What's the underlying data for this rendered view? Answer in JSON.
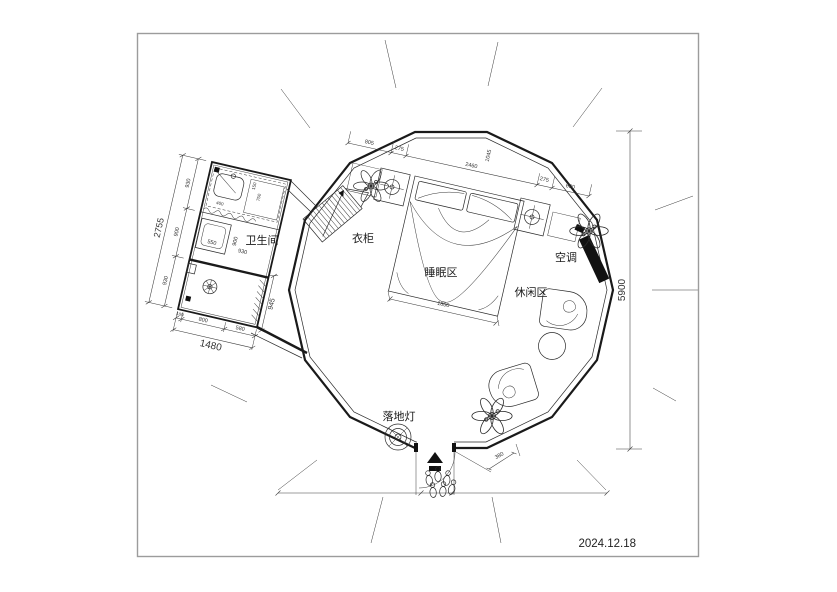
{
  "labels": {
    "bathroom": "卫生间",
    "wardrobe": "衣柜",
    "sleeping": "睡眠区",
    "leisure": "休闲区",
    "ac": "空调",
    "lamp": "落地灯"
  },
  "footer": {
    "date": "2024.12.18"
  },
  "dims": {
    "top": [
      "805",
      "275",
      "2460",
      "1045",
      "275",
      "690"
    ],
    "right_overall": "5900",
    "bed_width": "1800",
    "door": "380",
    "bath_left": [
      "930",
      "900",
      "930"
    ],
    "bath_left_overall": "2755",
    "bath_bottom": [
      "100",
      "800",
      "580"
    ],
    "bath_bottom_overall": "1480",
    "bath_right": "945",
    "bath_interior": [
      "400",
      "150",
      "750",
      "550",
      "900",
      "930"
    ]
  },
  "colors": {
    "line": "#1a1a1a",
    "dim": "#3a3a3a",
    "wall_fill": "#111111",
    "table_fill": "#dcdcdc",
    "frame": "#9c9c9c"
  }
}
